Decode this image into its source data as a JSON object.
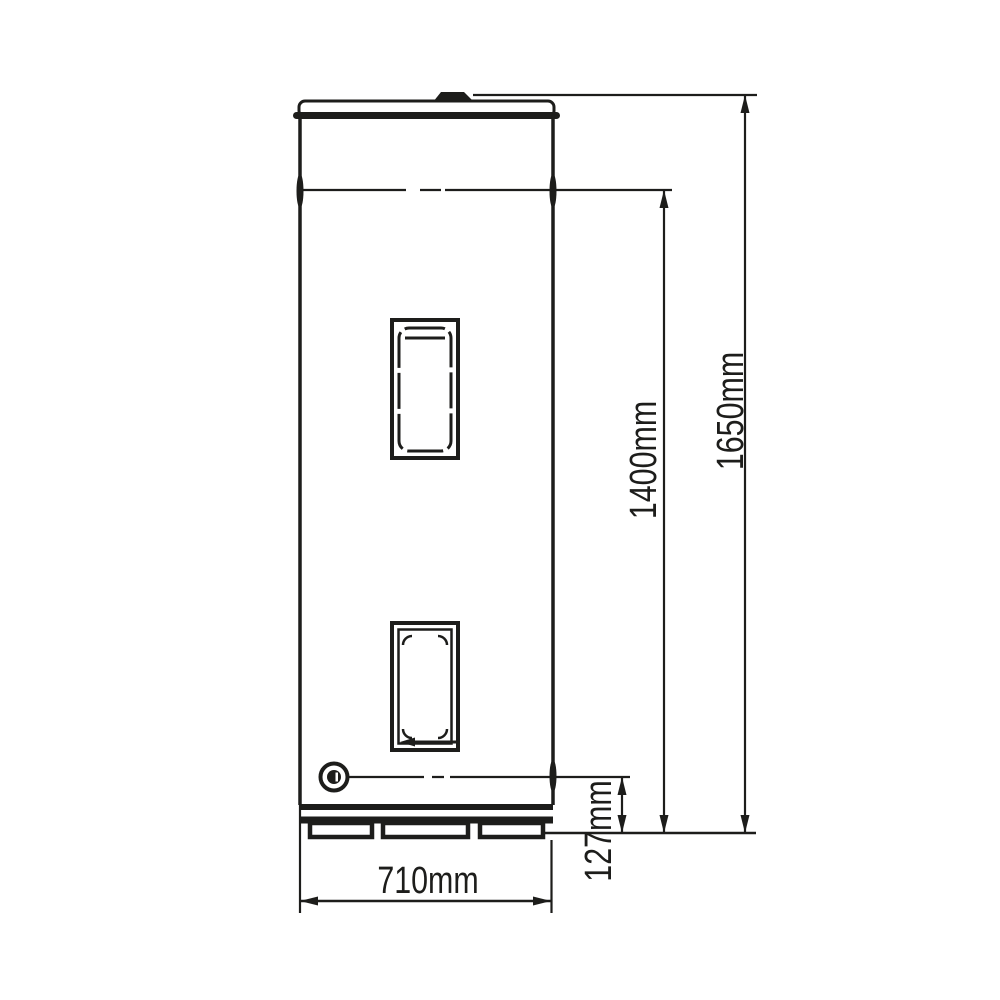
{
  "diagram": {
    "colors": {
      "ink": "#1d1d1b",
      "paper": "#ffffff"
    },
    "dimensions": {
      "total_height": "1650mm",
      "body_height": "1400mm",
      "base_height": "127mm",
      "width": "710mm"
    }
  }
}
